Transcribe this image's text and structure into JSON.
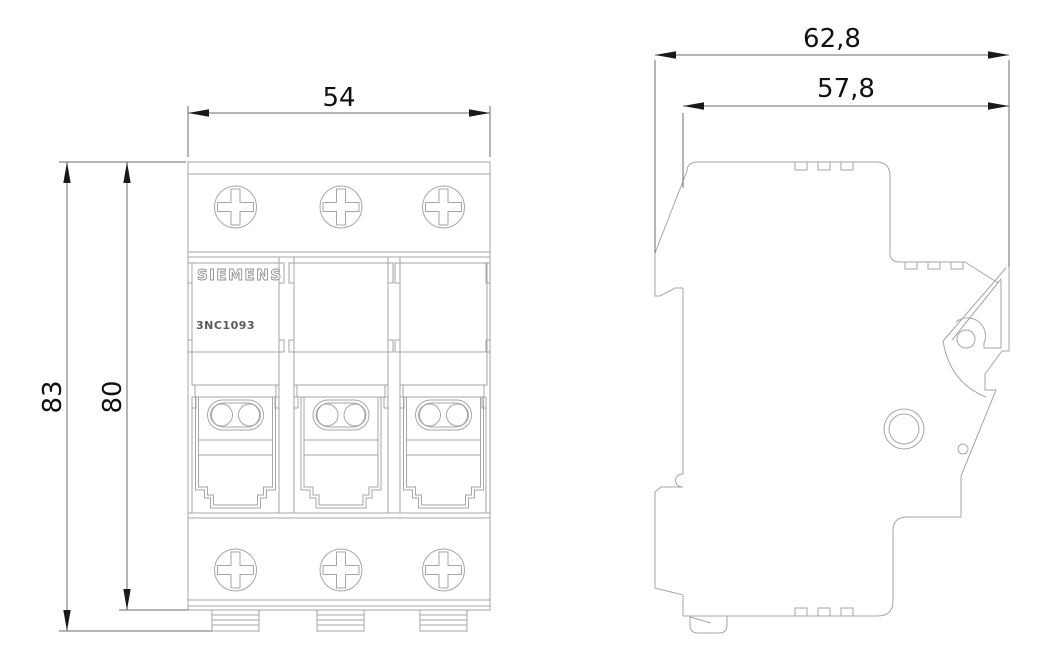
{
  "labels": {
    "brand": "SIEMENS",
    "model": "3NC1093"
  },
  "dimensions": {
    "front_width": "54",
    "front_height_overall": "83",
    "front_height_body": "80",
    "side_depth_overall": "62,8",
    "side_depth_body": "57,8"
  },
  "colors": {
    "background": "#ffffff",
    "part_line": "#a6a6a6",
    "dimension_line": "#6b6b6b",
    "text": "#111111"
  }
}
